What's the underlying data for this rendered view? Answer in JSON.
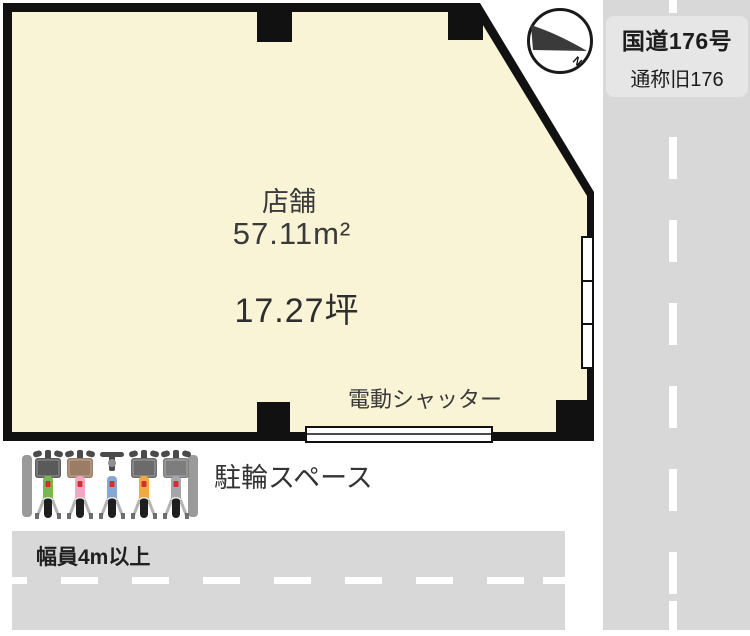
{
  "colors": {
    "wall": "#111111",
    "interior": "#faf4d6",
    "road": "#d8d8d8",
    "road_label_box": "#e6e6e6",
    "post": "#9a9a9a",
    "hardware": "#4a4a4a",
    "wheel": "#1e1e1e",
    "stand": "#b3b3b3",
    "tag": "#d03030"
  },
  "building": {
    "room_label": "店舗",
    "area_m2": "57.11m²",
    "area_tsubo": "17.27坪",
    "shutter_label": "電動シャッター"
  },
  "compass": {
    "north_label": "N"
  },
  "roads": {
    "right": {
      "line1": "国道176号",
      "line2": "通称旧176"
    },
    "bottom": {
      "width_label": "幅員4m以上"
    }
  },
  "bicycle_area": {
    "label": "駐輪スペース",
    "bikes": [
      {
        "frame": "#76b84b",
        "basket": "#5a5a5a"
      },
      {
        "frame": "#f2a7c3",
        "basket": "#9b7d66"
      },
      {
        "frame": "#86a8d0",
        "basket": null
      },
      {
        "frame": "#f0a93c",
        "basket": "#6b6b6b"
      },
      {
        "frame": "#a5a5ab",
        "basket": "#7d7d7d"
      }
    ]
  }
}
